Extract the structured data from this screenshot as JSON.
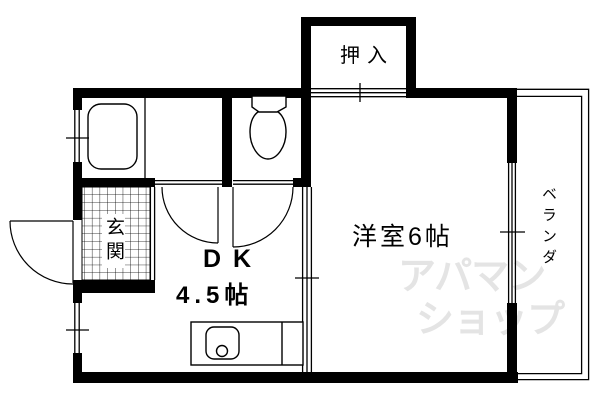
{
  "floorplan": {
    "labels": {
      "closet": "押入",
      "western_room": "洋室6帖",
      "dk": "DK",
      "dk_size": "4.5帖",
      "entrance": "玄関",
      "veranda": "ベランダ"
    },
    "watermark": {
      "line1": "アパマン",
      "line2": "ショップ",
      "color": "#e4e4e4"
    },
    "colors": {
      "background": "#ffffff",
      "line": "#000000"
    }
  }
}
